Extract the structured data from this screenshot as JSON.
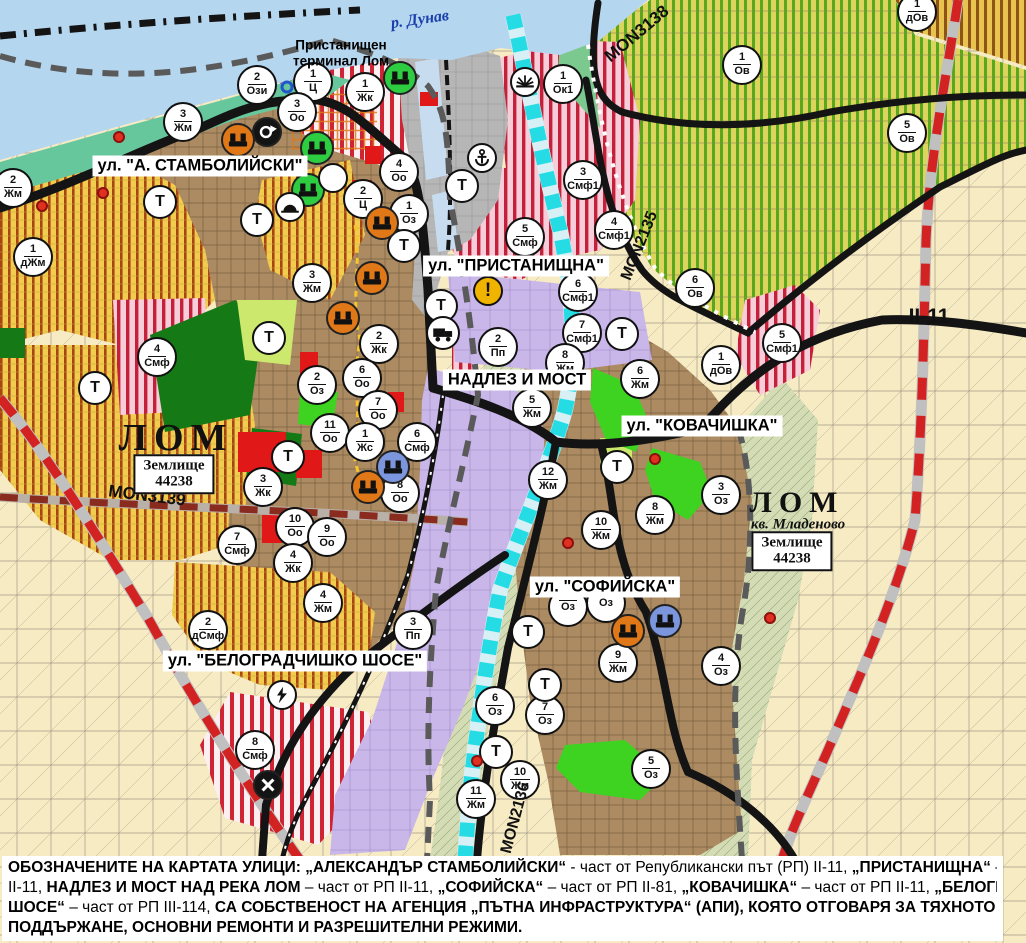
{
  "colors": {
    "danube_water": "#b5d6ef",
    "shore_green": "#66c79c",
    "urban_brown": "#ac8b62",
    "fields_beige": "#f7ebc4",
    "vineyard_green_stripe": "#57a81e",
    "orchard_yellow": "#f1cc4f",
    "mixed_zone_pink": "#f7cdd9",
    "mixed_zone_red_stripe": "#c5203a",
    "industry_purple": "#c9b7e9",
    "port_gray": "#b6b6b6",
    "park_green": "#157a15",
    "lom_river_cyan": "#25dce4",
    "road_black": "#141414",
    "road_red_dash": "#d22222",
    "badge_icon_orange": "#e07818",
    "badge_icon_blue": "#7b96dc",
    "badge_icon_green": "#2ecc40",
    "warning_yellow": "#f0b400"
  },
  "map": {
    "street_labels": [
      {
        "text": "ул. \"А. СТАМБОЛИЙСКИ\"",
        "x": 200,
        "y": 166
      },
      {
        "text": "ул. \"ПРИСТАНИЩНА\"",
        "x": 516,
        "y": 266
      },
      {
        "text": "НАДЛЕЗ И МОСТ",
        "x": 517,
        "y": 380
      },
      {
        "text": "ул. \"КОВАЧИШКА\"",
        "x": 702,
        "y": 426
      },
      {
        "text": "ул. \"СОФИЙСКА\"",
        "x": 605,
        "y": 587
      },
      {
        "text": "ул. \"БЕЛОГРАДЧИШКО ШОСЕ\"",
        "x": 295,
        "y": 661
      }
    ],
    "road_labels": [
      {
        "text": "MON3139",
        "x": 147,
        "y": 496,
        "rot": 7,
        "size": 17
      },
      {
        "text": "MON3138",
        "x": 637,
        "y": 34,
        "rot": -40,
        "size": 17
      },
      {
        "text": "MON2135",
        "x": 640,
        "y": 246,
        "rot": -68,
        "size": 16
      },
      {
        "text": "MON2136",
        "x": 516,
        "y": 818,
        "rot": -75,
        "size": 16
      },
      {
        "text": "II-11",
        "x": 929,
        "y": 317,
        "rot": 0,
        "size": 21
      }
    ],
    "place_labels": [
      {
        "kind": "river",
        "text": "р. Дунав",
        "x": 420,
        "y": 20,
        "rot": -8,
        "size": 16
      },
      {
        "kind": "terminal",
        "text": "Пристанищен\nтерминал Лом",
        "x": 341,
        "y": 53
      },
      {
        "kind": "city",
        "text": "ЛОМ",
        "x": 176,
        "y": 438,
        "size": 38
      },
      {
        "kind": "landbox",
        "text": "Землище\n44238",
        "x": 174,
        "y": 474
      },
      {
        "kind": "city",
        "text": "ЛОМ",
        "x": 797,
        "y": 503,
        "size": 30
      },
      {
        "kind": "sub",
        "text": "кв. Младеново",
        "x": 798,
        "y": 525,
        "size": 15
      },
      {
        "kind": "landbox",
        "text": "Землище\n44238",
        "x": 792,
        "y": 551
      }
    ],
    "badges": [
      {
        "n": "2",
        "c": "Ози",
        "x": 257,
        "y": 85
      },
      {
        "n": "1",
        "c": "Ц",
        "x": 313,
        "y": 82
      },
      {
        "n": "1",
        "c": "Жк",
        "x": 365,
        "y": 92
      },
      {
        "n": "3",
        "c": "Оо",
        "x": 297,
        "y": 112
      },
      {
        "n": "3",
        "c": "Жм",
        "x": 183,
        "y": 122
      },
      {
        "n": "2",
        "c": "Жм",
        "x": 13,
        "y": 188
      },
      {
        "n": "1",
        "c": "дЖм",
        "x": 33,
        "y": 257
      },
      {
        "n": "1",
        "c": "Ок1",
        "x": 563,
        "y": 84
      },
      {
        "n": "1",
        "c": "Ов",
        "x": 742,
        "y": 65
      },
      {
        "n": "1",
        "c": "дОв",
        "x": 917,
        "y": 12
      },
      {
        "n": "5",
        "c": "Ов",
        "x": 907,
        "y": 133
      },
      {
        "n": "3",
        "c": "Смф1",
        "x": 583,
        "y": 180
      },
      {
        "n": "4",
        "c": "Смф1",
        "x": 614,
        "y": 230
      },
      {
        "n": "5",
        "c": "Смф",
        "x": 525,
        "y": 237
      },
      {
        "n": "4",
        "c": "Оо",
        "x": 399,
        "y": 172
      },
      {
        "n": "2",
        "c": "Ц",
        "x": 363,
        "y": 199
      },
      {
        "n": "1",
        "c": "Оз",
        "x": 409,
        "y": 214
      },
      {
        "n": "6",
        "c": "Смф1",
        "x": 578,
        "y": 292
      },
      {
        "n": "7",
        "c": "Смф1",
        "x": 582,
        "y": 333
      },
      {
        "n": "6",
        "c": "Ов",
        "x": 695,
        "y": 288
      },
      {
        "n": "1",
        "c": "дОв",
        "x": 721,
        "y": 365
      },
      {
        "n": "5",
        "c": "Смф1",
        "x": 782,
        "y": 343
      },
      {
        "n": "3",
        "c": "Жм",
        "x": 312,
        "y": 283
      },
      {
        "n": "2",
        "c": "Оз",
        "x": 317,
        "y": 385
      },
      {
        "n": "4",
        "c": "Смф",
        "x": 157,
        "y": 357
      },
      {
        "n": "2",
        "c": "Жк",
        "x": 379,
        "y": 344
      },
      {
        "n": "6",
        "c": "Оо",
        "x": 362,
        "y": 378
      },
      {
        "n": "7",
        "c": "Оо",
        "x": 378,
        "y": 410
      },
      {
        "n": "11",
        "c": "Оо",
        "x": 330,
        "y": 433
      },
      {
        "n": "1",
        "c": "Жс",
        "x": 365,
        "y": 442
      },
      {
        "n": "6",
        "c": "Смф",
        "x": 417,
        "y": 442
      },
      {
        "n": "8",
        "c": "Оо",
        "x": 400,
        "y": 493
      },
      {
        "n": "3",
        "c": "Жк",
        "x": 263,
        "y": 487
      },
      {
        "n": "10",
        "c": "Оо",
        "x": 295,
        "y": 527
      },
      {
        "n": "9",
        "c": "Оо",
        "x": 327,
        "y": 537
      },
      {
        "n": "4",
        "c": "Жк",
        "x": 293,
        "y": 563
      },
      {
        "n": "7",
        "c": "Смф",
        "x": 237,
        "y": 545
      },
      {
        "n": "4",
        "c": "Жм",
        "x": 323,
        "y": 603
      },
      {
        "n": "8",
        "c": "Жм",
        "x": 565,
        "y": 363
      },
      {
        "n": "6",
        "c": "Жм",
        "x": 640,
        "y": 379
      },
      {
        "n": "5",
        "c": "Жм",
        "x": 532,
        "y": 408
      },
      {
        "n": "12",
        "c": "Жм",
        "x": 548,
        "y": 480
      },
      {
        "n": "10",
        "c": "Жм",
        "x": 601,
        "y": 530
      },
      {
        "n": "8",
        "c": "Жм",
        "x": 655,
        "y": 515
      },
      {
        "n": "3",
        "c": "Оз",
        "x": 721,
        "y": 495
      },
      {
        "n": "2",
        "c": "дСмф",
        "x": 208,
        "y": 630
      },
      {
        "n": "3",
        "c": "Пп",
        "x": 413,
        "y": 630
      },
      {
        "n": "2",
        "c": "Пп",
        "x": 498,
        "y": 347
      },
      {
        "n": "8",
        "c": "Смф",
        "x": 255,
        "y": 750
      },
      {
        "n": "",
        "c": "Оз",
        "x": 568,
        "y": 607
      },
      {
        "n": "",
        "c": "Оз",
        "x": 606,
        "y": 603
      },
      {
        "n": "9",
        "c": "Жм",
        "x": 618,
        "y": 663
      },
      {
        "n": "4",
        "c": "Оз",
        "x": 721,
        "y": 666
      },
      {
        "n": "6",
        "c": "Оз",
        "x": 495,
        "y": 706
      },
      {
        "n": "7",
        "c": "Оз",
        "x": 545,
        "y": 715
      },
      {
        "n": "5",
        "c": "Оз",
        "x": 651,
        "y": 769
      },
      {
        "n": "10",
        "c": "Жм",
        "x": 520,
        "y": 780
      },
      {
        "n": "11",
        "c": "Жм",
        "x": 476,
        "y": 799
      }
    ],
    "t_label": "Т",
    "t_badges": [
      {
        "x": 160,
        "y": 202
      },
      {
        "x": 257,
        "y": 220
      },
      {
        "x": 404,
        "y": 246
      },
      {
        "x": 462,
        "y": 186
      },
      {
        "x": 441,
        "y": 306
      },
      {
        "x": 269,
        "y": 338
      },
      {
        "x": 95,
        "y": 388
      },
      {
        "x": 288,
        "y": 457
      },
      {
        "x": 622,
        "y": 334
      },
      {
        "x": 617,
        "y": 467
      },
      {
        "x": 528,
        "y": 632
      },
      {
        "x": 545,
        "y": 685
      },
      {
        "x": 496,
        "y": 752
      }
    ],
    "warning_label": "!",
    "icons": [
      {
        "name": "port-crane-icon",
        "style": "green",
        "x": 400,
        "y": 78
      },
      {
        "name": "landmark-icon",
        "style": "green",
        "x": 317,
        "y": 148
      },
      {
        "name": "landmark-icon",
        "style": "green",
        "x": 308,
        "y": 190
      },
      {
        "name": "culture-monument-icon",
        "style": "orange",
        "x": 238,
        "y": 140
      },
      {
        "name": "culture-monument-icon",
        "style": "orange",
        "x": 382,
        "y": 223
      },
      {
        "name": "culture-monument-icon",
        "style": "orange",
        "x": 372,
        "y": 278
      },
      {
        "name": "culture-monument-icon",
        "style": "orange",
        "x": 343,
        "y": 318
      },
      {
        "name": "culture-monument-icon",
        "style": "orange",
        "x": 368,
        "y": 487
      },
      {
        "name": "culture-monument-icon",
        "style": "orange",
        "x": 628,
        "y": 631
      },
      {
        "name": "culture-monument-icon",
        "style": "blue",
        "x": 393,
        "y": 467
      },
      {
        "name": "culture-monument-icon",
        "style": "blue",
        "x": 665,
        "y": 621
      },
      {
        "name": "roundabout-icon",
        "style": "black",
        "x": 267,
        "y": 132
      },
      {
        "name": "arch-icon",
        "style": "white",
        "x": 290,
        "y": 207
      },
      {
        "name": "clover-icon",
        "style": "white",
        "x": 333,
        "y": 178
      },
      {
        "name": "anchor-icon",
        "style": "white",
        "x": 482,
        "y": 158
      },
      {
        "name": "sunrise-icon",
        "style": "white",
        "x": 525,
        "y": 82
      },
      {
        "name": "warning-icon",
        "style": "yellow",
        "x": 488,
        "y": 291
      },
      {
        "name": "truck-icon",
        "style": "white",
        "x": 443,
        "y": 333
      },
      {
        "name": "lightning-icon",
        "style": "white",
        "x": 282,
        "y": 695
      },
      {
        "name": "railway-crossing-icon",
        "style": "black",
        "x": 268,
        "y": 785
      }
    ],
    "red_dots": [
      {
        "x": 119,
        "y": 137
      },
      {
        "x": 103,
        "y": 193
      },
      {
        "x": 42,
        "y": 206
      },
      {
        "x": 655,
        "y": 459
      },
      {
        "x": 568,
        "y": 543
      },
      {
        "x": 477,
        "y": 761
      },
      {
        "x": 770,
        "y": 618
      }
    ],
    "blue_rings": [
      {
        "x": 287,
        "y": 87
      }
    ]
  },
  "caption": {
    "lines": [
      [
        {
          "t": "ОБОЗНАЧЕНИТЕ НА КАРТАТА УЛИЦИ: „АЛЕКСАНДЪР СТАМБОЛИЙСКИ“",
          "b": 1
        },
        {
          "t": " - част от Републикански път (РП) II-11, ",
          "b": 0
        },
        {
          "t": "„ПРИСТАНИЩНА“",
          "b": 1
        },
        {
          "t": " – част от РП",
          "b": 0
        }
      ],
      [
        {
          "t": "II-11, ",
          "b": 0
        },
        {
          "t": "НАДЛЕЗ И МОСТ НАД РЕКА ЛОМ",
          "b": 1
        },
        {
          "t": " – част от РП II-11, ",
          "b": 0
        },
        {
          "t": "„СОФИЙСКА“",
          "b": 1
        },
        {
          "t": " – част от РП II-81, ",
          "b": 0
        },
        {
          "t": "„КОВАЧИШКА“",
          "b": 1
        },
        {
          "t": " – част от РП II-11, ",
          "b": 0
        },
        {
          "t": "„БЕЛОГРАДЧИШКО",
          "b": 1
        }
      ],
      [
        {
          "t": "ШОСЕ“",
          "b": 1
        },
        {
          "t": " – част от РП III-114, ",
          "b": 0
        },
        {
          "t": "СА СОБСТВЕНОСТ НА АГЕНЦИЯ „ПЪТНА ИНФРАСТРУКТУРА“ (АПИ), КОЯТО ОТГОВАРЯ ЗА ТЯХНОТО ТЕКУЩО",
          "b": 1
        }
      ],
      [
        {
          "t": "ПОДДЪРЖАНЕ, ОСНОВНИ РЕМОНТИ И РАЗРЕШИТЕЛНИ РЕЖИМИ.",
          "b": 1
        }
      ]
    ]
  }
}
